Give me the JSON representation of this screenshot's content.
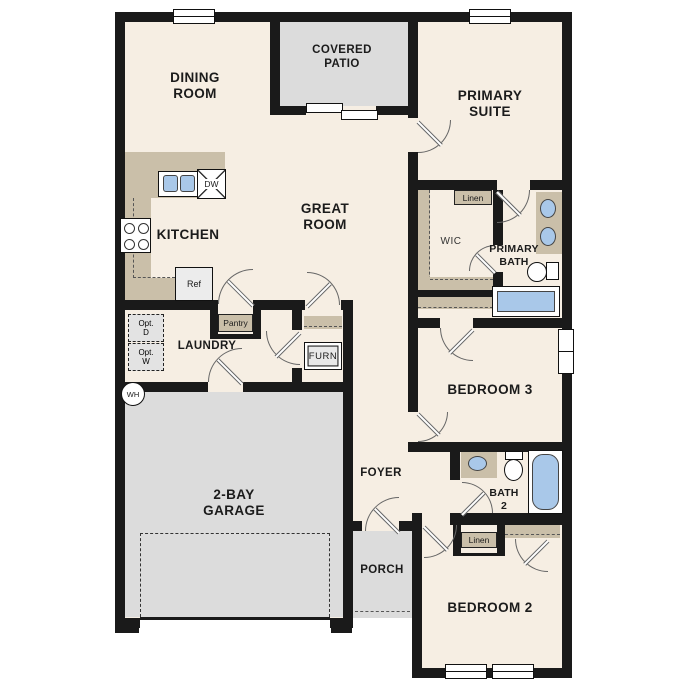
{
  "rooms": {
    "dining": {
      "l1": "DINING",
      "l2": "ROOM"
    },
    "patio": {
      "l1": "COVERED",
      "l2": "PATIO"
    },
    "suite": {
      "l1": "PRIMARY",
      "l2": "SUITE"
    },
    "kitchen": {
      "label": "KITCHEN"
    },
    "great": {
      "l1": "GREAT",
      "l2": "ROOM"
    },
    "wic": {
      "label": "WIC"
    },
    "pbath": {
      "l1": "PRIMARY",
      "l2": "BATH"
    },
    "laundry": {
      "label": "LAUNDRY"
    },
    "bedroom3": {
      "label": "BEDROOM 3"
    },
    "garage": {
      "l1": "2-BAY",
      "l2": "GARAGE"
    },
    "foyer": {
      "label": "FOYER"
    },
    "bath2": {
      "l1": "BATH",
      "l2": "2"
    },
    "porch": {
      "label": "PORCH"
    },
    "bedroom2": {
      "label": "BEDROOM 2"
    }
  },
  "features": {
    "pantry": "Pantry",
    "linen_primary": "Linen",
    "linen_hall": "Linen",
    "furnace": "FURN",
    "fridge": "Ref",
    "dishwasher": "DW",
    "water_heater": "WH",
    "opt_d": {
      "l1": "Opt.",
      "l2": "D"
    },
    "opt_w": {
      "l1": "Opt.",
      "l2": "W"
    }
  },
  "colors": {
    "floor": "#f6eee3",
    "outdoor_concrete": "#dcdcdc",
    "cabinetry": "#cabfa9",
    "plumbing_blue": "#a9c8e9",
    "wall": "#1a1a1a"
  }
}
